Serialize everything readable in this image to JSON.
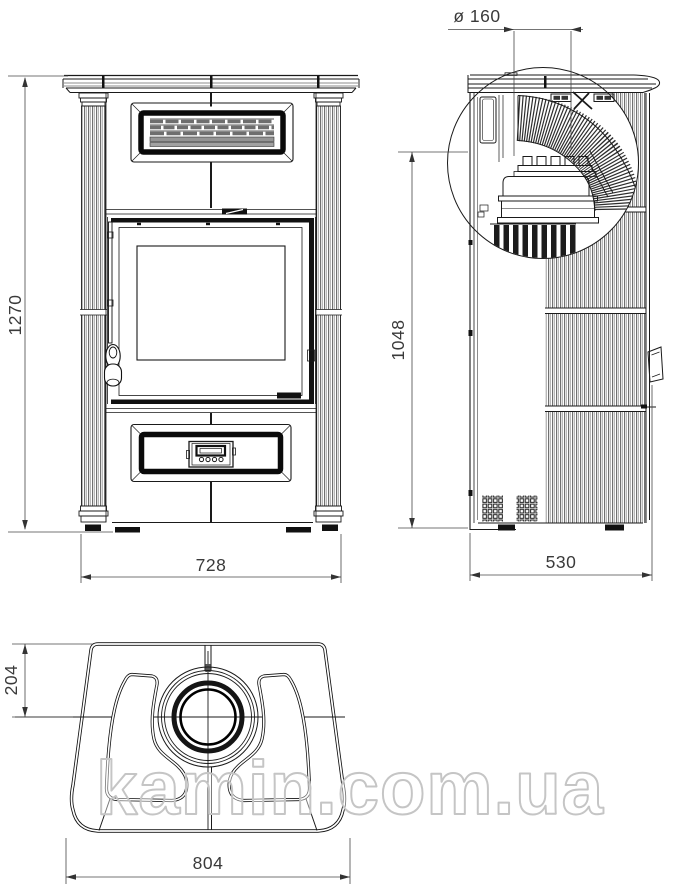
{
  "dimensions": {
    "flue_diameter": "ø 160",
    "front_height": "1270",
    "front_width": "728",
    "side_height": "1048",
    "side_depth": "530",
    "top_rear_offset": "204",
    "top_width": "804"
  },
  "watermark": "kamin.com.ua",
  "colors": {
    "line": "#1a1a1a",
    "dimension": "#3a3a3a",
    "hatch": "#2e2e2e",
    "grille_fill": "#979797",
    "watermark": "#c5c5c5",
    "background": "#ffffff"
  }
}
